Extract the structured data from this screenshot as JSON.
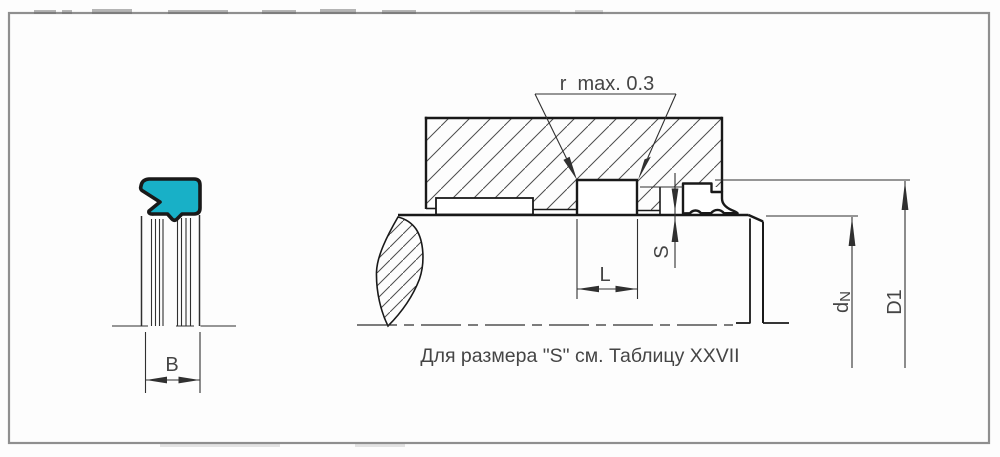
{
  "drawing": {
    "footnote": "Для размера \"S\" см. Таблицу XXVII",
    "labels": {
      "b": "B",
      "l": "L",
      "s": "S",
      "r_note": "r  max. 0.3",
      "d_rod_base": "d",
      "d_rod_sub": "N",
      "d_outer": "D1"
    },
    "colors": {
      "seal_fill": "#18b0c7",
      "line": "#303030",
      "outline": "#191919",
      "frame": "#8f8f8f",
      "text": "#454545"
    }
  }
}
